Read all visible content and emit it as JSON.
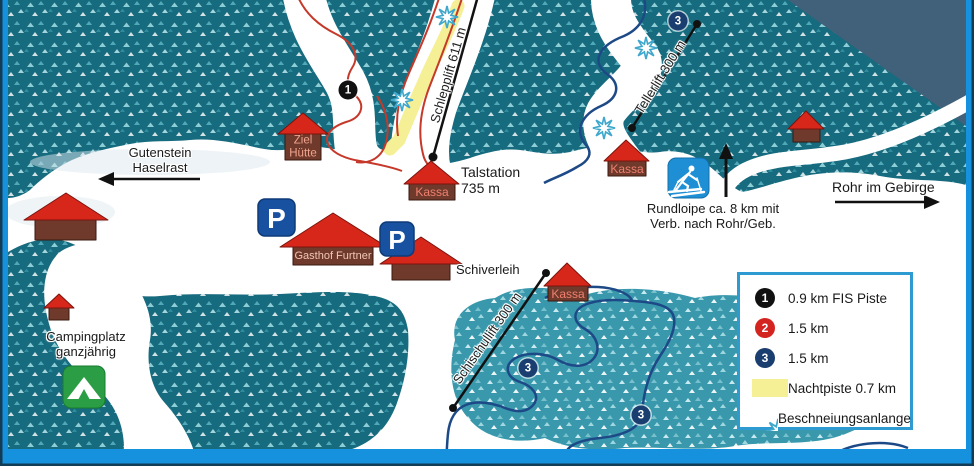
{
  "map": {
    "directions": {
      "west_line1": "Gutenstein",
      "west_line2": "Haselrast",
      "east": "Rohr im Gebirge"
    },
    "lifts": {
      "schlepplift": "Schlepplift 611 m",
      "tellerlift": "Tellerlift 300 m",
      "schischullift": "Schischullift 300 m"
    },
    "stations": {
      "kassa": "Kassa",
      "talstation_line1": "Talstation",
      "talstation_line2": "735 m",
      "ziel_line1": "Ziel",
      "ziel_line2": "Hütte"
    },
    "places": {
      "gasthof_furtner": "Gasthof Furtner",
      "schiverleih": "Schiverleih",
      "camping_line1": "Campingplatz",
      "camping_line2": "ganzjährig"
    },
    "loipe": {
      "line1": "Rundloipe ca. 8 km mit",
      "line2": "Verb. nach Rohr/Geb."
    },
    "markers": {
      "run1": "1",
      "run2": "2",
      "run3": "3"
    },
    "icons": {
      "parking_letter": "P"
    }
  },
  "legend": {
    "items": [
      {
        "marker": "1",
        "label": "0.9 km FIS Piste"
      },
      {
        "marker": "2",
        "label": "1.5 km"
      },
      {
        "marker": "3",
        "label": "1.5 km"
      },
      {
        "marker": "nachtpiste-swatch",
        "label": "Nachtpiste 0.7 km"
      },
      {
        "marker": "snowflake",
        "label": "Beschneiungsanlange"
      }
    ]
  },
  "colors": {
    "forest_teal": "#176b7e",
    "forest_light": "#2f93a8",
    "mountain_grey": "#41607a",
    "frame_blue": "#1691dd",
    "frame_navy": "#123c55",
    "piste_red": "#c5392b",
    "loipe_blue": "#1d4a87",
    "nachtpiste_yellow": "#f5ef96",
    "marker_black": "#111111",
    "marker_red": "#d42420",
    "marker_navy": "#1b3e70",
    "roof_red": "#d7271b",
    "hut_brown": "#6f3a2b",
    "parking_blue": "#17519f",
    "loipe_icon_blue": "#1e8fd5",
    "camping_green": "#2b9e45",
    "snowflake_blue": "#3fa8cc"
  }
}
